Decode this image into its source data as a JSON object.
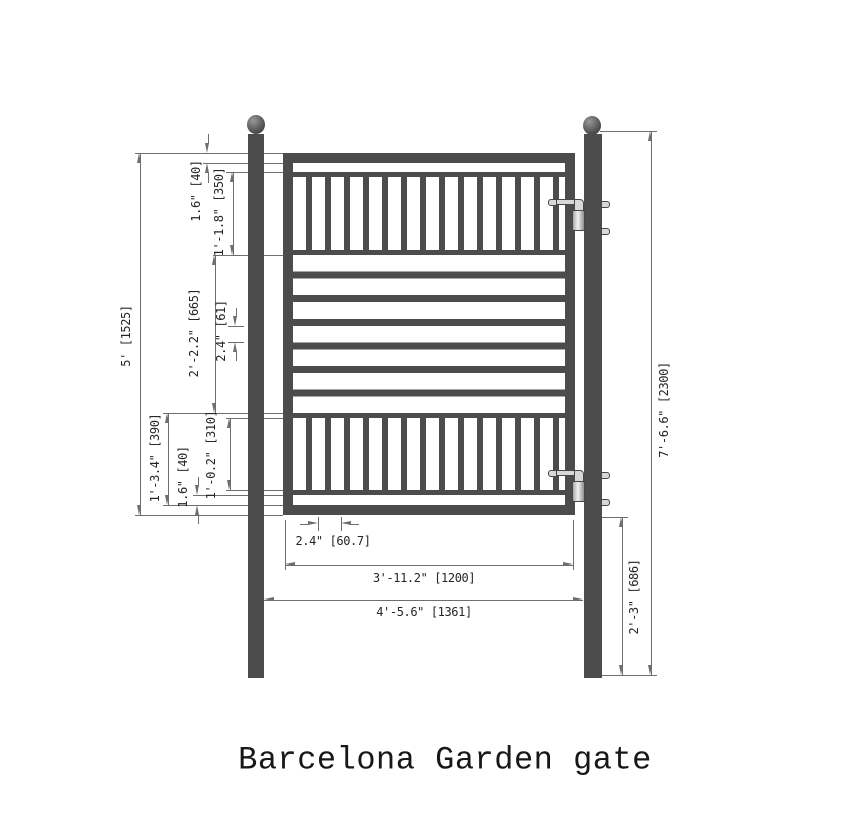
{
  "title": "Barcelona Garden gate",
  "colors": {
    "structure": "#4c4c4c",
    "dimline": "#6e6e6e",
    "dimtext": "#262626",
    "bg": "#ffffff"
  },
  "dims": {
    "gate_height": "5' [1525]",
    "top_frame": "1.6\" [40]",
    "top_panel": "1'-1.8\" [350]",
    "mid_section": "2'-2.2\" [665]",
    "mid_bar_gap": "2.4\" [61]",
    "bottom_panel": "1'-3.4\" [390]",
    "bottom_pickets": "1'-0.2\" [310]",
    "bottom_gap": "1.6\" [40]",
    "post_height": "7'-6.6\" [2300]",
    "hinge_offset": "2'-3\" [686]",
    "picket_gap": "2.4\" [60.7]",
    "gate_width": "3'-11.2\" [1200]",
    "overall_width": "4'-5.6\" [1361]"
  }
}
